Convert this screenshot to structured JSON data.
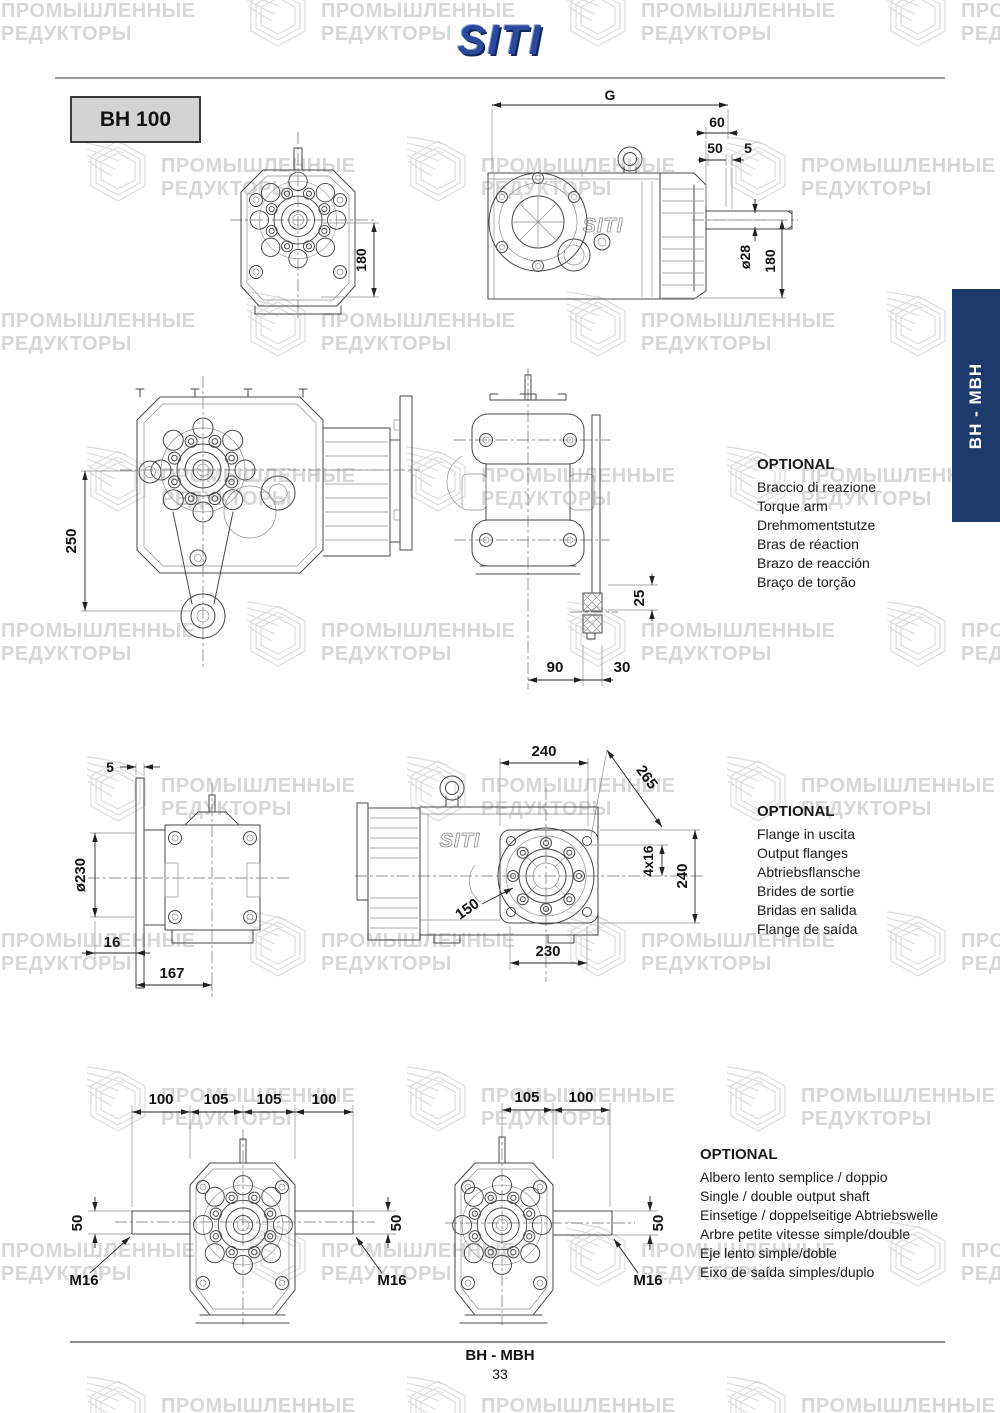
{
  "watermark": {
    "line1": "ПРОМЫШЛЕННЫЕ",
    "line2": "РЕДУКТОРЫ"
  },
  "header": {
    "logo": "SITI"
  },
  "model_label": "BH 100",
  "side_tab_label": "BH - MBH",
  "embossed_logo": "SITI",
  "footer": {
    "series": "BH - MBH",
    "page_number": "33"
  },
  "colors": {
    "tab_navy": "#1d3a6d",
    "logo_blue": "#2b4a9e",
    "watermark_gray": "#d7d7d7",
    "model_box_gray": "#d3d3d3"
  },
  "drawings": {
    "front_view": {
      "height": "180"
    },
    "side_view": {
      "g": "G",
      "d60": "60",
      "d50": "50",
      "d5": "5",
      "shaft_dia": "ø28",
      "height": "180"
    },
    "torque_front": {
      "d250": "250"
    },
    "torque_side": {
      "d25": "25",
      "d90": "90",
      "d30": "30"
    },
    "flange_side": {
      "d5": "5",
      "dia": "ø230",
      "d16": "16",
      "d167": "167"
    },
    "flange_view": {
      "top": "240",
      "diag": "265",
      "holes": "4x16",
      "right": "240",
      "bore": "150",
      "bottom": "230"
    },
    "double_shaft": {
      "seg1": "100",
      "seg2": "105",
      "seg3": "105",
      "seg4": "100",
      "dia_left": "50",
      "dia_right": "50",
      "thread_left": "M16",
      "thread_right": "M16"
    },
    "single_shaft": {
      "seg1": "105",
      "seg2": "100",
      "dia": "50",
      "thread": "M16"
    }
  },
  "optional_blocks": [
    {
      "title": "OPTIONAL",
      "lines": [
        "Braccio di reazione",
        "Torque arm",
        "Drehmomentstutze",
        "Bras de réaction",
        "Brazo de reacción",
        "Braço de torção"
      ]
    },
    {
      "title": "OPTIONAL",
      "lines": [
        "Flange in uscita",
        "Output flanges",
        "Abtriebsflansche",
        "Brides de sortie",
        "Bridas en salida",
        "Flange de saída"
      ]
    },
    {
      "title": "OPTIONAL",
      "lines": [
        "Albero lento semplice / doppio",
        "Single / double output shaft",
        "Einsetige / doppelseitige Abtriebswelle",
        "Arbre petite vitesse simple/double",
        "Eje lento simple/doble",
        "Eixo de saída simples/duplo"
      ]
    }
  ]
}
